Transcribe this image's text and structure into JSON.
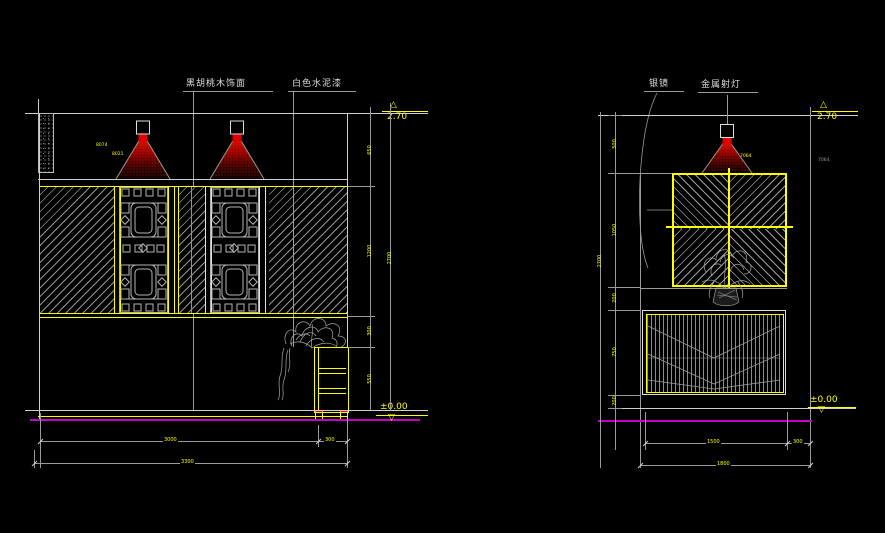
{
  "drawing": {
    "type": "interior-elevation-cad",
    "background": "#000000",
    "colors": {
      "accent_yellow": "#ffff00",
      "line_white": "#cfcfcf",
      "line_gray": "#9a9a9a",
      "floor_magenta": "#c400c4",
      "lamp_red": "#ff1a00",
      "centerline_lavender": "#8a8ad8"
    }
  },
  "left": {
    "callouts": {
      "wood": "黑胡桃木饰面",
      "paint": "白色水泥漆"
    },
    "markers": {
      "top": "2.70",
      "bottom": "±0.00"
    },
    "dims": {
      "v1": "650",
      "v2": "1200",
      "v3": "300",
      "v4": "550",
      "v_total": "2700",
      "b1": "3000",
      "b2": "300",
      "b_total": "3300"
    },
    "notes": {
      "n1": "8074",
      "n2": "8021"
    }
  },
  "right": {
    "callouts": {
      "mirror": "银镜",
      "spotlight": "金属射灯"
    },
    "markers": {
      "top": "2.70",
      "bottom": "±0.00"
    },
    "dims": {
      "v1": "500",
      "v2": "1050",
      "v3": "200",
      "v4": "750",
      "v5": "200",
      "v_total": "2700",
      "b1": "1500",
      "b2": "300",
      "b_total": "1800"
    },
    "notes": {
      "n1": "7064",
      "n2": "7064"
    }
  }
}
